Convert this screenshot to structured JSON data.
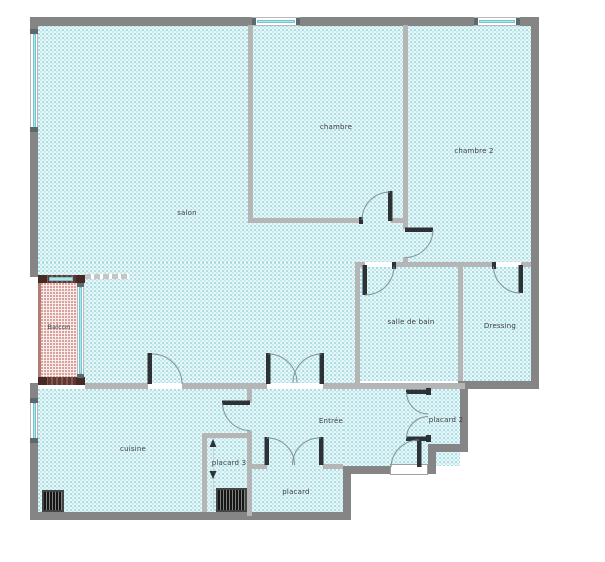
{
  "floorplan": {
    "type": "apartment-floor-plan",
    "rooms": [
      {
        "id": "salon",
        "label": "salon"
      },
      {
        "id": "chambre",
        "label": "chambre"
      },
      {
        "id": "chambre-2",
        "label": "chambre 2"
      },
      {
        "id": "salle-de-bain",
        "label": "salle de bain"
      },
      {
        "id": "dressing",
        "label": "Dressing"
      },
      {
        "id": "cuisine",
        "label": "cuisine"
      },
      {
        "id": "entree",
        "label": "Entrée"
      },
      {
        "id": "placard",
        "label": "placard"
      },
      {
        "id": "placard-2",
        "label": "placard 2"
      },
      {
        "id": "placard-3",
        "label": "placard 3"
      },
      {
        "id": "balcon",
        "label": "Balcon"
      }
    ],
    "colors": {
      "exterior_wall": "#858585",
      "interior_wall": "#b5b5b5",
      "floor_tint": "#6ec6cf",
      "balcony_wall": "#5c3a33",
      "balcony_tint": "#be695f",
      "window_glass": "#aee6ef",
      "door_leaf": "#2d3236"
    }
  }
}
